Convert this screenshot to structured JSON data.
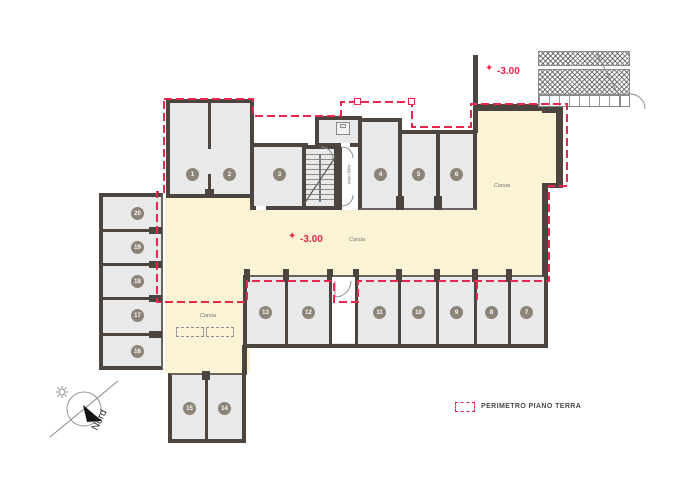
{
  "labels": {
    "level": "-3.00",
    "corsia": "Corsia",
    "vano_filtro": "Vano filtro",
    "nord": "Nord"
  },
  "legend": {
    "perimeter_label": "PERIMETRO PIANO TERRA"
  },
  "icons": {
    "level_star": "✦"
  },
  "stalls": [
    "1",
    "2",
    "3",
    "4",
    "5",
    "6",
    "7",
    "8",
    "9",
    "10",
    "11",
    "12",
    "13",
    "14",
    "15",
    "16",
    "17",
    "18",
    "19",
    "20"
  ],
  "colors": {
    "wall": "#4c453f",
    "room_fill": "#e9e9ea",
    "corridor_fill": "#faf3d6",
    "perimeter_red": "#e8274d",
    "badge": "#8c8379"
  }
}
